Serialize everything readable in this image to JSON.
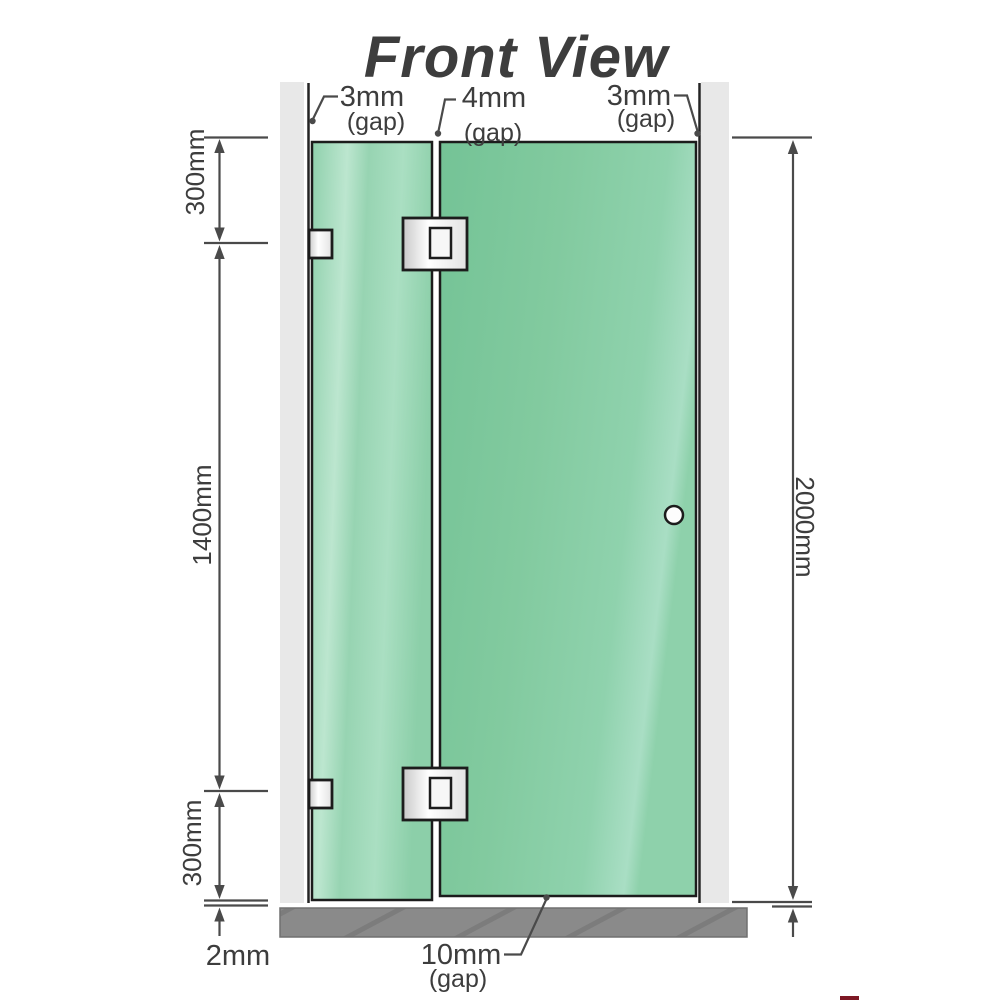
{
  "title": "Front View",
  "labels": {
    "gap_left": {
      "value": "3mm",
      "suffix": "(gap)"
    },
    "gap_middle": {
      "value": "4mm",
      "suffix": "(gap)"
    },
    "gap_right": {
      "value": "3mm",
      "suffix": "(gap)"
    },
    "gap_bottom": {
      "value": "10mm",
      "suffix": "(gap)"
    },
    "floor_gap": "2mm",
    "dim_top": "300mm",
    "dim_middle": "1400mm",
    "dim_bottom": "300mm",
    "dim_total": "2000mm"
  },
  "colors": {
    "title": "#a0a0a0",
    "annotation": "#3d3d3d",
    "dimension_line": "#4a4a4a",
    "wall": "#e8e8e8",
    "wall_edge_line": "#242424",
    "glass_left_panel": "#9bd7b6",
    "glass_door_panel": "#7ec89e",
    "hardware_fill": "#f2f2f2",
    "hardware_border": "#1c1c1c",
    "floor": "#8a8a8a",
    "logo_sliver": "#7d1824"
  }
}
